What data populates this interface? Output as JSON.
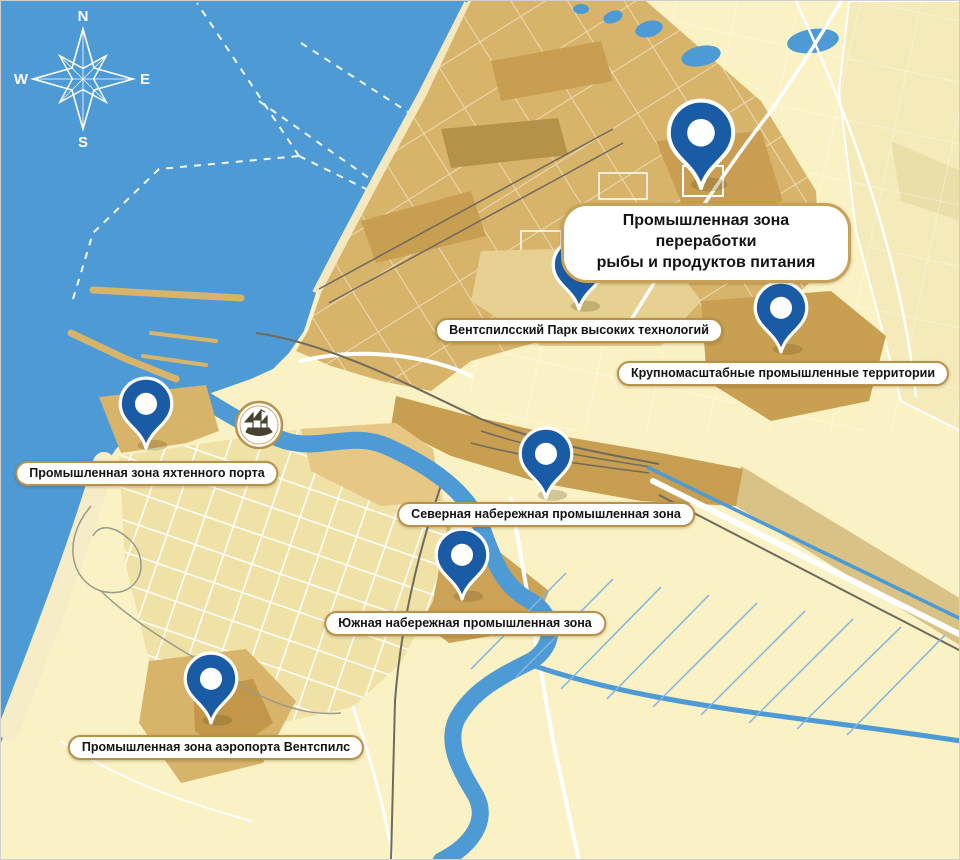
{
  "compass": {
    "north": "N",
    "east": "E",
    "south": "S",
    "west": "W"
  },
  "markers": [
    {
      "id": "fish-food-processing",
      "label": "Промышленная зона переработки\nрыбы и продуктов питания",
      "primary": true
    },
    {
      "id": "high-tech-park",
      "label": "Вентспилсский Парк высоких технологий"
    },
    {
      "id": "large-scale-industrial",
      "label": "Крупномасштабные промышленные территории"
    },
    {
      "id": "yacht-port",
      "label": "Промышленная зона яхтенного порта"
    },
    {
      "id": "north-embankment",
      "label": "Северная набережная промышленная зона"
    },
    {
      "id": "south-embankment",
      "label": "Южная набережная промышленная зона"
    },
    {
      "id": "airport",
      "label": "Промышленная зона аэропорта Вентспилс"
    }
  ],
  "colors": {
    "sea": "#4E9AD5",
    "land": "#FAF2C5",
    "beach": "#F6EDC8",
    "city_block": "#F0E2A6",
    "industrial_light": "#E6D193",
    "industrial": "#D8B46A",
    "industrial_dark": "#C89E50",
    "industrial_darkest": "#B69149",
    "pin_blue": "#1A5BA6",
    "label_border": "#B8914B",
    "road": "#FFFFFF",
    "rail": "#6E6B5E",
    "ditch": "#7FB6E0"
  }
}
